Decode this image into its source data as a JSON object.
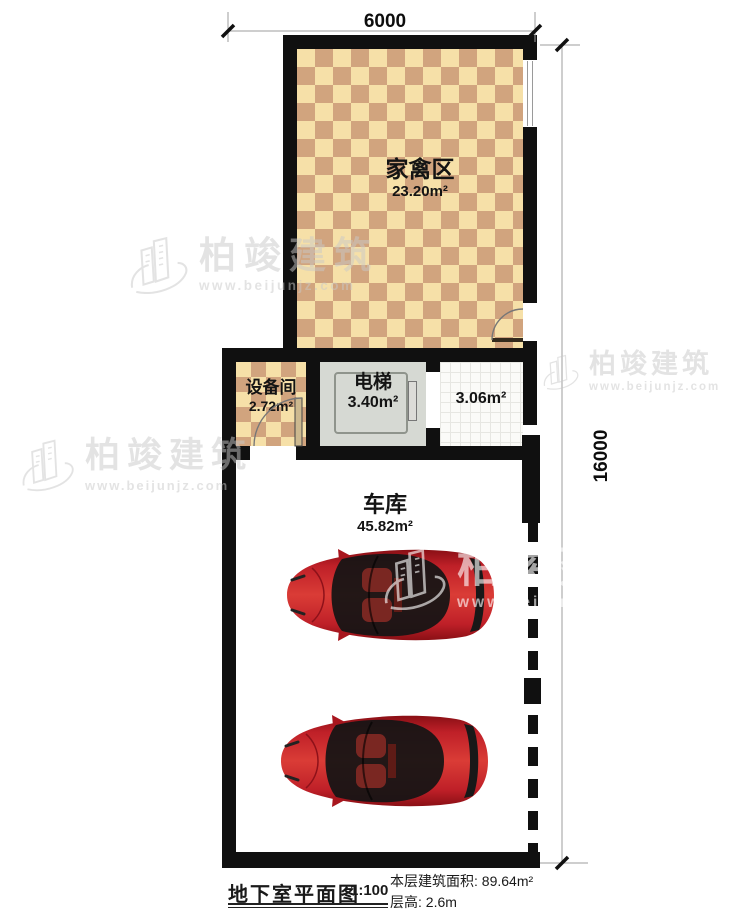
{
  "plan": {
    "type": "basement-floor-plan"
  },
  "rooms": {
    "poultry": {
      "name": "家禽区",
      "area": "23.20m²"
    },
    "equipment": {
      "name": "设备间",
      "area": "2.72m²"
    },
    "elevator": {
      "name": "电梯",
      "area": "3.40m²"
    },
    "lobby": {
      "area": "3.06m²"
    },
    "garage": {
      "name": "车库",
      "area": "45.82m²"
    }
  },
  "dimensions": {
    "width": "6000",
    "height": "16000"
  },
  "title_block": {
    "name": "地下室平面图",
    "scale": "1:100",
    "floor_area": "本层建筑面积: 89.64m²",
    "floor_height": "层高: 2.6m"
  },
  "watermark": {
    "brand": "柏竣建筑",
    "url": "www.beijunjz.com"
  },
  "colors": {
    "wall": "#101010",
    "checker_light": "#f6e0a8",
    "checker_dark": "#d1a47e",
    "elevator_fill": "#d6d9d3",
    "car_red": "#c0232b",
    "dimension_line": "#9c9c9c",
    "watermark_gray": "#c9c9c9"
  }
}
